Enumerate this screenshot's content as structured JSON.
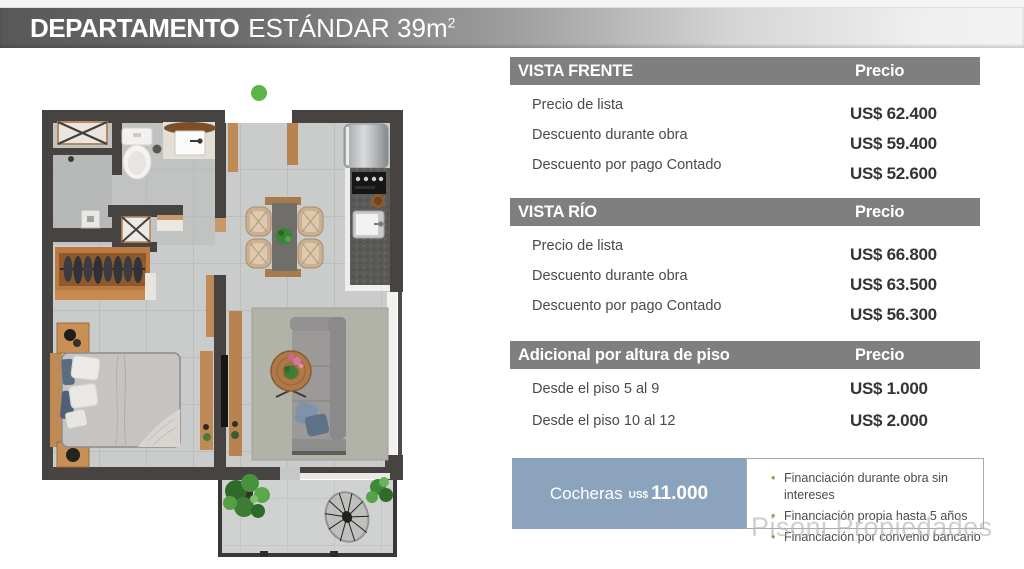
{
  "title": {
    "product_bold": "DEPARTAMENTO",
    "product_regular": "ESTÁNDAR 39m",
    "area_superscript": "2"
  },
  "price_tables": [
    {
      "header": "VISTA FRENTE",
      "price_column_header": "Precio",
      "rows": [
        {
          "label": "Precio de lista",
          "price": "US$ 62.400"
        },
        {
          "label": "Descuento durante obra",
          "price": "US$ 59.400"
        },
        {
          "label": "Descuento por pago Contado",
          "price": "US$ 52.600"
        }
      ]
    },
    {
      "header": "VISTA RÍO",
      "price_column_header": "Precio",
      "rows": [
        {
          "label": "Precio de lista",
          "price": "US$ 66.800"
        },
        {
          "label": "Descuento durante obra",
          "price": "US$ 63.500"
        },
        {
          "label": "Descuento por pago Contado",
          "price": "US$ 56.300"
        }
      ]
    },
    {
      "header": "Adicional por altura de piso",
      "price_column_header": "Precio",
      "rows": [
        {
          "label": "Desde el piso 5 al 9",
          "price": "US$ 1.000"
        },
        {
          "label": "Desde el piso 10 al 12",
          "price": "US$ 2.000"
        }
      ]
    }
  ],
  "parking": {
    "label": "Cocheras",
    "currency": "US$",
    "amount": "11.000"
  },
  "financing": {
    "bullets": [
      "Financiación durante obra sin intereses",
      "Financiación propia hasta 5 años",
      "Financiación por convenio bancario"
    ]
  },
  "watermark": "Pisoni Propiedades",
  "colors": {
    "header_bar": "#7f7f7f",
    "parking_box": "#8ba3bc",
    "bullet_olive": "#9b9b4e",
    "marker_green": "#5ab648"
  }
}
